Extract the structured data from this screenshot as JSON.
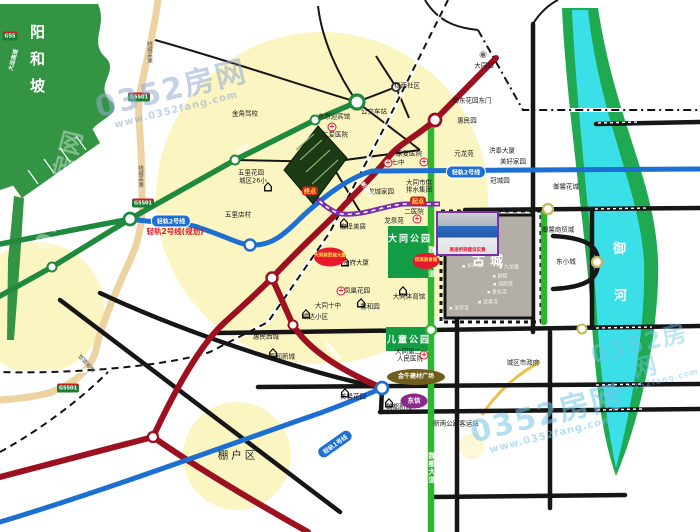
{
  "watermark": {
    "brand": "0352房网",
    "url": "www.0352fang.com"
  },
  "regions": {
    "hill": "阳和坡",
    "old_city": "古城",
    "river": [
      "御",
      "河"
    ],
    "park1": "大同公园",
    "park2": "儿童公园",
    "shanty": "棚户区"
  },
  "photo_caption": "高速桥梁建设实景",
  "colors": {
    "hill_green": "#339544",
    "river_cyan": "#3adfe8",
    "bank_green": "#1faa52",
    "road_black": "#161616",
    "road_red": "#9c1020",
    "rail_blue": "#1d6fd1",
    "route_purple": "#7a2fae",
    "road_green": "#1f8a3d",
    "avenue_green": "#2fb52f",
    "expressway_beige": "#edd3a2",
    "highlight_yellow": "#fbf5c2",
    "park_green": "#139c43",
    "accent_red": "#e8192c"
  },
  "labels": [
    {
      "t": "金角驾校",
      "x": 245,
      "y": 114
    },
    {
      "t": "京原迎宾馆",
      "x": 334,
      "y": 117
    },
    {
      "t": "仁爱医院",
      "x": 335,
      "y": 135
    },
    {
      "t": "公交车站",
      "x": 374,
      "y": 112
    },
    {
      "t": "梧西社区",
      "x": 407,
      "y": 86
    },
    {
      "t": "大同站",
      "x": 484,
      "y": 66
    },
    {
      "t": "康复医院",
      "x": 409,
      "y": 154
    },
    {
      "t": "七中",
      "x": 398,
      "y": 163
    },
    {
      "t": "御东花园东门",
      "x": 472,
      "y": 101
    },
    {
      "t": "惠民园",
      "x": 467,
      "y": 121
    },
    {
      "t": "元龙苑",
      "x": 464,
      "y": 154
    },
    {
      "t": "洪泰大厦",
      "x": 502,
      "y": 151
    },
    {
      "t": "美好家园",
      "x": 513,
      "y": 162
    },
    {
      "t": "冠城园",
      "x": 500,
      "y": 181
    },
    {
      "t": "御馨花城",
      "x": 566,
      "y": 187
    },
    {
      "t": "御馨商贸城",
      "x": 558,
      "y": 230
    },
    {
      "t": "东小城",
      "x": 566,
      "y": 262
    },
    {
      "t": "二医院",
      "x": 414,
      "y": 212
    },
    {
      "t": "龙泉苑",
      "x": 394,
      "y": 221
    },
    {
      "t": "大同市供",
      "x": 419,
      "y": 183
    },
    {
      "t": "排水集团",
      "x": 419,
      "y": 190
    },
    {
      "t": "龙城家园",
      "x": 381,
      "y": 192
    },
    {
      "t": "宏泽美居",
      "x": 353,
      "y": 227
    },
    {
      "t": "金府大厦",
      "x": 356,
      "y": 263
    },
    {
      "t": "凤凰花园",
      "x": 357,
      "y": 291
    },
    {
      "t": "大同十中",
      "x": 328,
      "y": 306
    },
    {
      "t": "馨和园",
      "x": 370,
      "y": 307
    },
    {
      "t": "顺达小区",
      "x": 315,
      "y": 317
    },
    {
      "t": "大同体育馆",
      "x": 409,
      "y": 297
    },
    {
      "t": "惠民西城",
      "x": 266,
      "y": 337
    },
    {
      "t": "五里店村",
      "x": 238,
      "y": 215
    },
    {
      "t": "五里花园",
      "x": 251,
      "y": 173
    },
    {
      "t": "城区26小",
      "x": 253,
      "y": 181
    },
    {
      "t": "春和新城",
      "x": 282,
      "y": 357
    },
    {
      "t": "美馨花园",
      "x": 353,
      "y": 397
    },
    {
      "t": "魏都新城",
      "x": 399,
      "y": 407
    },
    {
      "t": "大同第二",
      "x": 408,
      "y": 352
    },
    {
      "t": "人民医院",
      "x": 410,
      "y": 359
    },
    {
      "t": "新南公路客运站",
      "x": 456,
      "y": 424
    },
    {
      "t": "城区市政府",
      "x": 523,
      "y": 363
    },
    {
      "t": "轻轨2号线(规划)",
      "x": 175,
      "y": 232,
      "c": "plan-red"
    },
    {
      "t": "绕城高速",
      "x": 149,
      "y": 52,
      "c": "vtiny"
    },
    {
      "t": "绕城高速",
      "x": 140,
      "y": 176,
      "c": "vtiny"
    },
    {
      "t": "绕城高速",
      "x": 86,
      "y": 364,
      "c": "vtiny",
      "r": -42
    },
    {
      "t": "魏都大道",
      "x": 431,
      "y": 262,
      "c": "vroad"
    },
    {
      "t": "魏都大道",
      "x": 431,
      "y": 468,
      "c": "vroad"
    },
    {
      "t": "云冈路",
      "x": 243,
      "y": 150,
      "c": "on-line",
      "r": -27
    },
    {
      "t": "新建路",
      "x": 366,
      "y": 190,
      "c": "on-line",
      "r": 55
    },
    {
      "t": "新建南路",
      "x": 332,
      "y": 352,
      "c": "on-line",
      "r": 48
    },
    {
      "t": "大运高速",
      "x": 14,
      "y": 60,
      "c": "on-line",
      "r": -75
    }
  ],
  "gucheng_pois": [
    {
      "t": "仿古街",
      "x": 459,
      "y": 240
    },
    {
      "t": "华严寺",
      "x": 472,
      "y": 267
    },
    {
      "t": "九龙壁",
      "x": 509,
      "y": 268
    },
    {
      "t": "鼓楼",
      "x": 500,
      "y": 277
    },
    {
      "t": "纯阳宫",
      "x": 503,
      "y": 285
    },
    {
      "t": "善化寺",
      "x": 497,
      "y": 293
    },
    {
      "t": "清真寺",
      "x": 488,
      "y": 303
    },
    {
      "t": "法华寺",
      "x": 459,
      "y": 309
    }
  ],
  "pills": [
    {
      "t": "轻轨2号线",
      "x": 171,
      "y": 221,
      "c": "rail"
    },
    {
      "t": "轻轨2号线",
      "x": 466,
      "y": 172,
      "c": "rail"
    },
    {
      "t": "轻轨1号线",
      "x": 335,
      "y": 444,
      "c": "rail",
      "r": -35
    },
    {
      "t": "起点",
      "x": 418,
      "y": 201,
      "c": "flag"
    },
    {
      "t": "终点",
      "x": 310,
      "y": 191,
      "c": "flag"
    }
  ],
  "badges": [
    {
      "t": "G5501",
      "x": 139,
      "y": 97
    },
    {
      "t": "G5501",
      "x": 143,
      "y": 203
    },
    {
      "t": "G5501",
      "x": 68,
      "y": 388
    },
    {
      "t": "G55",
      "x": 10,
      "y": 36
    }
  ],
  "ellipses": [
    {
      "t": "大同商贸城大厦",
      "x": 330,
      "y": 257,
      "w": 32,
      "h": 19,
      "bg": "#e8192c",
      "fg": "#ffe34d",
      "fs": 4.5
    },
    {
      "t": "佳琪美食城",
      "x": 426,
      "y": 261,
      "w": 27,
      "h": 16,
      "bg": "#e8192c",
      "fg": "#ffe34d",
      "fs": 4.5
    },
    {
      "t": "金牛建材广场",
      "x": 416,
      "y": 377,
      "w": 58,
      "h": 16,
      "bg": "#6f5d1b",
      "fg": "#ffffff",
      "fs": 6
    },
    {
      "t": "东信",
      "x": 414,
      "y": 401,
      "w": 27,
      "h": 15,
      "bg": "#8b2a8b",
      "fg": "#ffffff",
      "fs": 6.5
    }
  ],
  "icon_glyphs": {
    "cross": "+",
    "building": "⌂",
    "station": "◉"
  },
  "icons": [
    {
      "k": "cross",
      "x": 332,
      "y": 127
    },
    {
      "k": "cross",
      "x": 417,
      "y": 219
    },
    {
      "k": "cross",
      "x": 424,
      "y": 162
    },
    {
      "k": "cross",
      "x": 388,
      "y": 163
    },
    {
      "k": "cross",
      "x": 424,
      "y": 355
    },
    {
      "k": "cross",
      "x": 341,
      "y": 291
    },
    {
      "k": "building",
      "x": 268,
      "y": 186
    },
    {
      "k": "building",
      "x": 345,
      "y": 261
    },
    {
      "k": "building",
      "x": 306,
      "y": 313
    },
    {
      "k": "building",
      "x": 344,
      "y": 222
    },
    {
      "k": "building",
      "x": 273,
      "y": 352
    },
    {
      "k": "building",
      "x": 345,
      "y": 392
    },
    {
      "k": "building",
      "x": 389,
      "y": 402
    },
    {
      "k": "building",
      "x": 361,
      "y": 302
    },
    {
      "k": "building",
      "x": 403,
      "y": 290
    },
    {
      "k": "station",
      "x": 483,
      "y": 55
    }
  ],
  "nodes": [
    {
      "x": 357,
      "y": 102,
      "r": 7,
      "ring": "#1f8a3d"
    },
    {
      "x": 315,
      "y": 120,
      "r": 4.5,
      "ring": "#1f8a3d"
    },
    {
      "x": 235,
      "y": 160,
      "r": 4.5,
      "ring": "#1f8a3d"
    },
    {
      "x": 130,
      "y": 219,
      "r": 6,
      "ring": "#1f8a3d"
    },
    {
      "x": 52,
      "y": 267,
      "r": 4.5,
      "ring": "#1f8a3d"
    },
    {
      "x": 431,
      "y": 330,
      "r": 5,
      "ring": "#2fb52f"
    },
    {
      "x": 250,
      "y": 245,
      "r": 5.5,
      "ring": "#1d6fd1"
    },
    {
      "x": 382,
      "y": 388,
      "r": 6,
      "ring": "#1d6fd1"
    },
    {
      "x": 435,
      "y": 120,
      "r": 6,
      "ring": "#9c1020"
    },
    {
      "x": 272,
      "y": 278,
      "r": 5.5,
      "ring": "#9c1020"
    },
    {
      "x": 293,
      "y": 325,
      "r": 4.5,
      "ring": "#9c1020"
    },
    {
      "x": 153,
      "y": 437,
      "r": 5,
      "ring": "#9c1020"
    },
    {
      "x": 548,
      "y": 209,
      "r": 5,
      "ring": "#c9b45a"
    },
    {
      "x": 597,
      "y": 262,
      "r": 5,
      "ring": "#c9b45a"
    },
    {
      "x": 582,
      "y": 329,
      "r": 4.5,
      "ring": "#c9b45a"
    },
    {
      "x": 396,
      "y": 87,
      "r": 4,
      "ring": "#333333"
    }
  ]
}
